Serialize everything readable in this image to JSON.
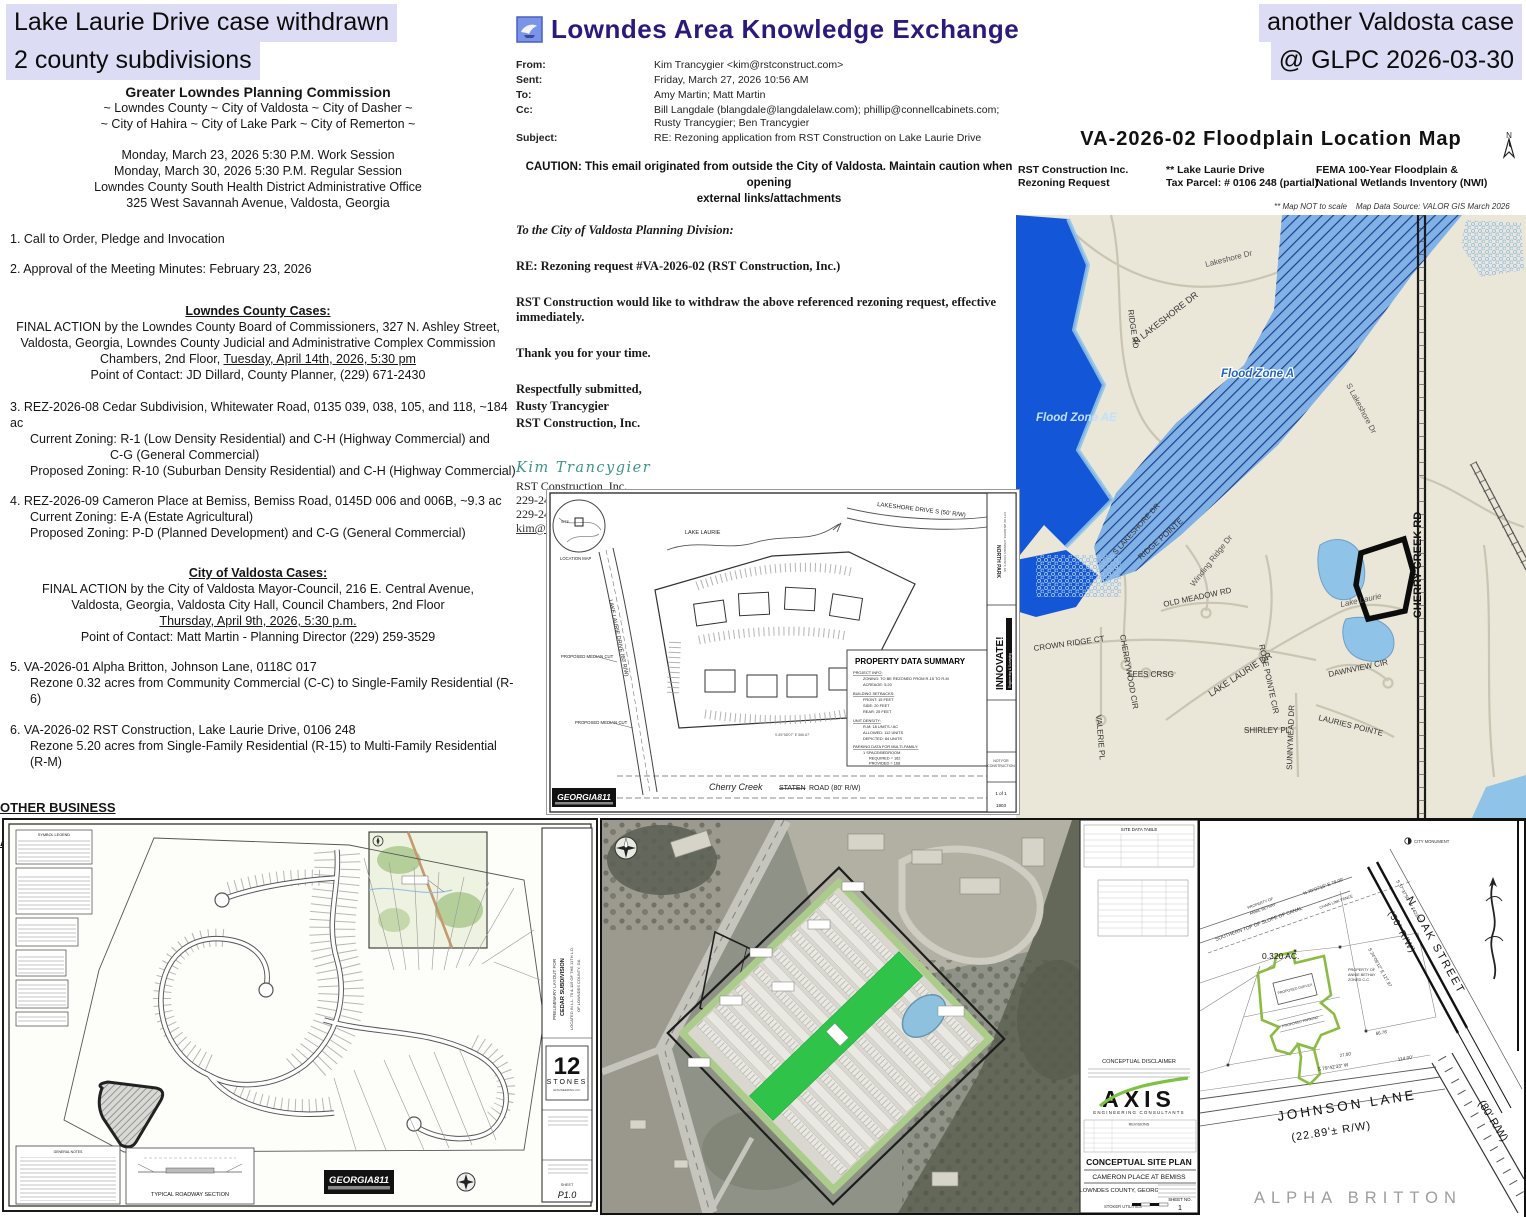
{
  "colors": {
    "highlight": "#dcdcf4",
    "brand_purple": "#2a1a7e",
    "flood_dark_blue": "#1456d8",
    "flood_light_blue": "#7db0e6",
    "hatch_navy": "#16378f",
    "map_beige": "#eae7d8",
    "site_green": "#2fc34a",
    "parcel_green": "#8cbb43",
    "axis_green": "#7dc242"
  },
  "annotations": {
    "tl1": "Lake Laurie Drive case withdrawn",
    "tl2": "2 county subdivisions",
    "tr1": "another Valdosta case",
    "tr2": "@ GLPC 2026-03-30"
  },
  "agenda": {
    "title": "Greater Lowndes Planning Commission",
    "subtitle1": "~ Lowndes County ~ City of Valdosta ~ City of Dasher ~",
    "subtitle2": "~ City of Hahira ~ City of Lake Park ~ City of Remerton ~",
    "session1": "Monday, March 23, 2026 5:30 P.M. Work Session",
    "session2": "Monday, March 30, 2026 5:30 P.M. Regular Session",
    "venue1": "Lowndes County South Health District Administrative Office",
    "venue2": "325 West Savannah Avenue, Valdosta, Georgia",
    "item1": "1.  Call to Order, Pledge and Invocation",
    "item2": "2.  Approval of the Meeting Minutes:  February 23, 2026",
    "county_header": "Lowndes County Cases:",
    "county_intro1": "FINAL ACTION by the Lowndes County Board of Commissioners, 327 N. Ashley Street,",
    "county_intro2": "Valdosta, Georgia, Lowndes County Judicial and Administrative Complex Commission",
    "county_intro3_pre": "Chambers, 2nd Floor, ",
    "county_intro3_date": "Tuesday, April 14th, 2026, 5:30 pm",
    "county_contact": "Point of Contact:  JD Dillard, County Planner, (229) 671-2430",
    "item3_1": "3.  REZ-2026-08  Cedar Subdivision, Whitewater Road, 0135 039, 038, 105, and 118, ~184 ac",
    "item3_2": "Current Zoning:   R-1 (Low Density Residential) and C-H (Highway Commercial) and",
    "item3_3": "C-G (General Commercial)",
    "item3_4": "Proposed Zoning:  R-10 (Suburban Density Residential) and C-H (Highway Commercial)",
    "item4_1": "4.  REZ-2026-09  Cameron Place at Bemiss, Bemiss Road, 0145D 006 and 006B, ~9.3 ac",
    "item4_2": "Current Zoning:  E-A (Estate Agricultural)",
    "item4_3": "Proposed Zoning:  P-D (Planned Development) and C-G (General Commercial)",
    "city_header": "City of Valdosta Cases:",
    "city_intro1": "FINAL ACTION by the City of Valdosta Mayor-Council, 216 E. Central Avenue,",
    "city_intro2": "Valdosta, Georgia, Valdosta City Hall, Council Chambers, 2nd Floor",
    "city_intro3_date": "Thursday, April 9th, 2026, 5:30 p.m.",
    "city_contact": "Point of Contact: Matt Martin - Planning Director (229) 259-3529",
    "item5_1": "5.  VA-2026-01  Alpha Britton, Johnson Lane, 0118C 017",
    "item5_2": "Rezone 0.32 acres from Community Commercial (C-C) to Single-Family Residential (R-6)",
    "item6_1": "6.  VA-2026-02   RST Construction, Lake Laurie Drive, 0106 248",
    "item6_2": "Rezone 5.20 acres from Single-Family Residential (R-15) to Multi-Family Residential (R-M)",
    "other_business": "OTHER BUSINESS",
    "adjournment": "ADJOURNMENT"
  },
  "email": {
    "brand": "Lowndes Area Knowledge Exchange",
    "fields": [
      {
        "label": "From:",
        "value": "Kim Trancygier <kim@rstconstruct.com>"
      },
      {
        "label": "Sent:",
        "value": "Friday, March 27, 2026 10:56 AM"
      },
      {
        "label": "To:",
        "value": "Amy Martin; Matt Martin"
      },
      {
        "label": "Cc:",
        "value": "Bill Langdale (blangdale@langdalelaw.com); phillip@connellcabinets.com; Rusty Trancygier; Ben Trancygier"
      },
      {
        "label": "Subject:",
        "value": "RE: Rezoning application from RST Construction on Lake Laurie Drive"
      }
    ],
    "caution1": "CAUTION: This email originated from outside the City of Valdosta. Maintain caution when opening",
    "caution2": "external links/attachments",
    "body1": "To the City of Valdosta Planning Division:",
    "body2": "RE:  Rezoning request #VA-2026-02 (RST Construction, Inc.)",
    "body3": "RST Construction would like to withdraw the above referenced rezoning request, effective immediately.",
    "body4": "Thank you for your time.",
    "body5": "Respectfully submitted,",
    "body6": "Rusty Trancygier",
    "body7": "RST Construction, Inc.",
    "sig_name": "Kim Trancygier",
    "sig1": "RST Construction, Inc.",
    "sig2": "229-244-3368 / Office",
    "sig3": "229-244-5641 / Fax",
    "sig4": "kim@rstconstruct.com"
  },
  "floodmap": {
    "title": "VA-2026-02   Floodplain   Location   Map",
    "applicant1": "RST Construction Inc.",
    "applicant2": "Rezoning Request",
    "address": "** Lake Laurie Drive",
    "parcel": "Tax Parcel:   # 0106 248   (partial)",
    "fema1": "FEMA 100-Year Floodplain &",
    "fema2": "National Wetlands Inventory (NWI)",
    "note_scale": "**    Map NOT to scale",
    "note_source": "Map Data Source:    VALOR GIS March 2026",
    "labels": {
      "flood_zone_ae": "Flood Zone AE",
      "flood_zone_a": "Flood Zone A",
      "n_lakeshore": "N LAKESHORE DR",
      "lakeshore_dr": "Lakeshore Dr",
      "ridge_rd": "RIDGE RD",
      "s_lakeshore": "S Lakeshore Dr",
      "s_lakeshore2": "S LAKESHORE DR",
      "cherry_creek": "CHERRY CREEK RD",
      "ridge_pointe": "RIDGE POINTE",
      "cherrywood": "CHERRYWOOD CIR",
      "old_meadow": "OLD MEADOW RD",
      "winding_ridge": "Winding Ridge Dr",
      "rose_pointe": "ROSE POINTE CIR",
      "crown_ridge": "CROWN RIDGE CT",
      "valerie": "VALERIE PL",
      "lees_crsg": "LEES CRSG",
      "lake_laurie_dr": "LAKE LAURIE DR",
      "dawnview": "DAWNVIEW CIR",
      "lauries_pointe": "LAURIES POINTE",
      "shirley": "SHIRLEY PL",
      "sunnymead": "SUNNYMEAD DR",
      "lake_laurie": "Lake Laurie"
    }
  },
  "concept": {
    "location_map": "LOCATION MAP",
    "site": "SITE",
    "lake_laurie": "LAKE LAURIE",
    "lakeshore": "LAKESHORE DRIVE S (50' R/W)",
    "street_left": "LAKE LAURIE DRIVE (60' R/W)",
    "median": "PROPOSED MEDIAN CUT",
    "pds_title": "PROPERTY DATA SUMMARY",
    "pds": [
      "PROJECT INFO:",
      "ZONING: TO BE REZONED FROM R-15 TO R-M",
      "ACREAGE: 5.20",
      "BUILDING SETBACKS:",
      "FRONT: 15 FEET",
      "SIDE: 20 FEET",
      "REAR: 25 FEET",
      "UNIT DENSITY:",
      "R-M: 18 UNITS / AC",
      "ALLOWED: 112 UNITS",
      "DEPICTED: 84 UNITS",
      "PARKING DATA FOR MULTI-FAMILY:",
      "1 SPACE/BEDROOM",
      "REQUIRED = 162",
      "PROVIDED = 168"
    ],
    "cherry_script": "Cherry Creek",
    "staten": "STATEN",
    "road80": "ROAD (80' R/W)",
    "georgia811": "GEORGIA811",
    "bearing_bottom": "S 89°58'07\" E  566.67'",
    "innovate": "INNOVATE!",
    "innovate_sub": "Engineering & Surveying",
    "north_park": "NORTH PARK",
    "np_loc1": "CITY OF VALDOSTA, LOWNDES COUNTY, GA",
    "not_for1": "NOT FOR",
    "not_for2": "CONSTRUCTION",
    "sheet": "1 of 1",
    "proj_no": "1903"
  },
  "cedar": {
    "legend": "SYMBOL LEGEND",
    "notes": "GENERAL NOTES",
    "t1": "PRELIMINARY LAYOUT FOR",
    "t2": "CEDAR SUBDIVISION",
    "t3": "LOCATED IN L.L. 70 & 115 OF THE 11TH L.D.",
    "t4": "OF LOWNDES COUNTY, GA",
    "twelve": "12",
    "stones": "STONES",
    "eng": "ENGINEERING CO.",
    "trs": "TYPICAL ROADWAY SECTION",
    "g811": "GEORGIA811",
    "sheet_label": "SHEET",
    "sheet_no": "P1.0"
  },
  "cameron": {
    "sdt": "SITE DATA TABLE",
    "disclaimer": "CONCEPTUAL DISCLAIMER",
    "axis": "AXIS",
    "axis_sub": "ENGINEERING CONSULTANTS",
    "revisions": "REVISIONS",
    "csp": "CONCEPTUAL SITE PLAN",
    "name": "CAMERON PLACE AT BEMISS",
    "county": "LOWNDES COUNTY, GEORGIA",
    "stoker": "STOKER UTILITIES",
    "sheet_label": "SHEET NO.",
    "sheet_no": "1"
  },
  "survey": {
    "oak1": "N.  OAK  STREET",
    "oak2": "(50'  R/W)",
    "rw80": "(80'  R/W)",
    "johnson1": "JOHNSON  LANE",
    "johnson2": "(22.89'±  R/W)",
    "acreage": "0.320 AC.",
    "duplex": "PROPOSED DUPLEX",
    "parking": "PROPOSED PARKING",
    "alpha": "ALPHA  BRITTON",
    "monument": "CITY MONUMENT",
    "canal": "SOUTHERN TOP OF SLOPE OF CANAL",
    "chain": "CHAIN LINK FENCE",
    "prop1": "PROPERTY OF",
    "prop2": "ANNIE BETHAY",
    "prop3": "ZONED C-C",
    "b1": "S 37°37'50\" W  2423.63",
    "b2": "N 70°07'15\" E   79.00'",
    "b3": "S 24°09'12\" E  127.97",
    "b4": "S 79°42'33\" W",
    "d1": "114.00'",
    "d2": "27.00'",
    "d3": "66.78'"
  }
}
